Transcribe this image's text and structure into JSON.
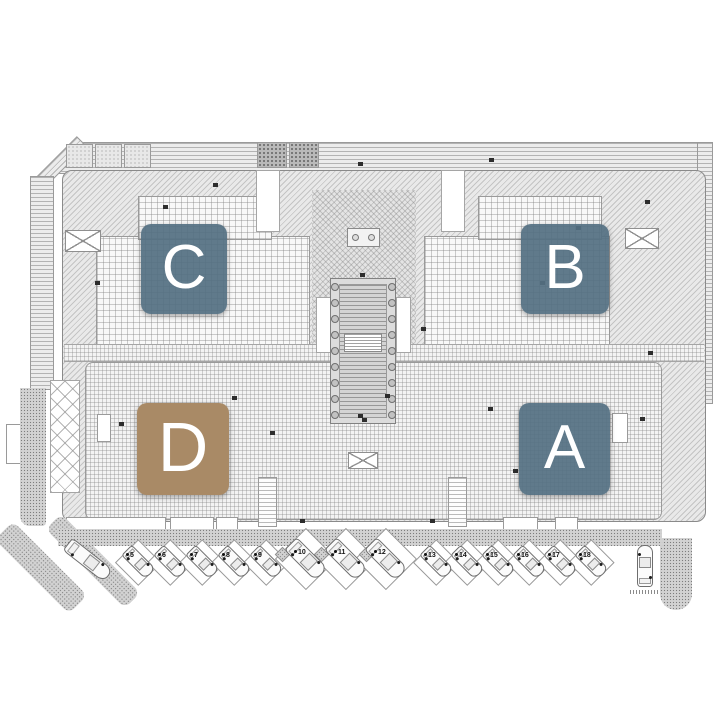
{
  "plan": {
    "type": "residential-complex-master-plan",
    "blocks": [
      {
        "id": "c",
        "label": "C"
      },
      {
        "id": "b",
        "label": "B"
      },
      {
        "id": "d",
        "label": "D"
      },
      {
        "id": "a",
        "label": "A"
      }
    ],
    "block_colors": {
      "standard": "rgba(84,112,130,0.93)",
      "highlight": "#a98a66",
      "letter": "#ffffff"
    },
    "parking": {
      "groups": [
        {
          "name": "left-row",
          "numbers": [
            "5",
            "6",
            "7",
            "8",
            "9"
          ]
        },
        {
          "name": "middle-row",
          "numbers": [
            "10",
            "11",
            "12"
          ]
        },
        {
          "name": "right-row",
          "numbers": [
            "13",
            "14",
            "15",
            "16",
            "17",
            "18"
          ]
        }
      ],
      "unnumbered_cars": [
        "entry-driveway-car",
        "loading-bay-car"
      ]
    },
    "icons": [
      "car-icon",
      "skylight-x-icon",
      "pool-icon",
      "pool-column-icon",
      "door-marker-icon",
      "planter-icon",
      "tree-bed-icon",
      "stair-icon",
      "ramp-icon",
      "roof-vent-icon"
    ]
  }
}
